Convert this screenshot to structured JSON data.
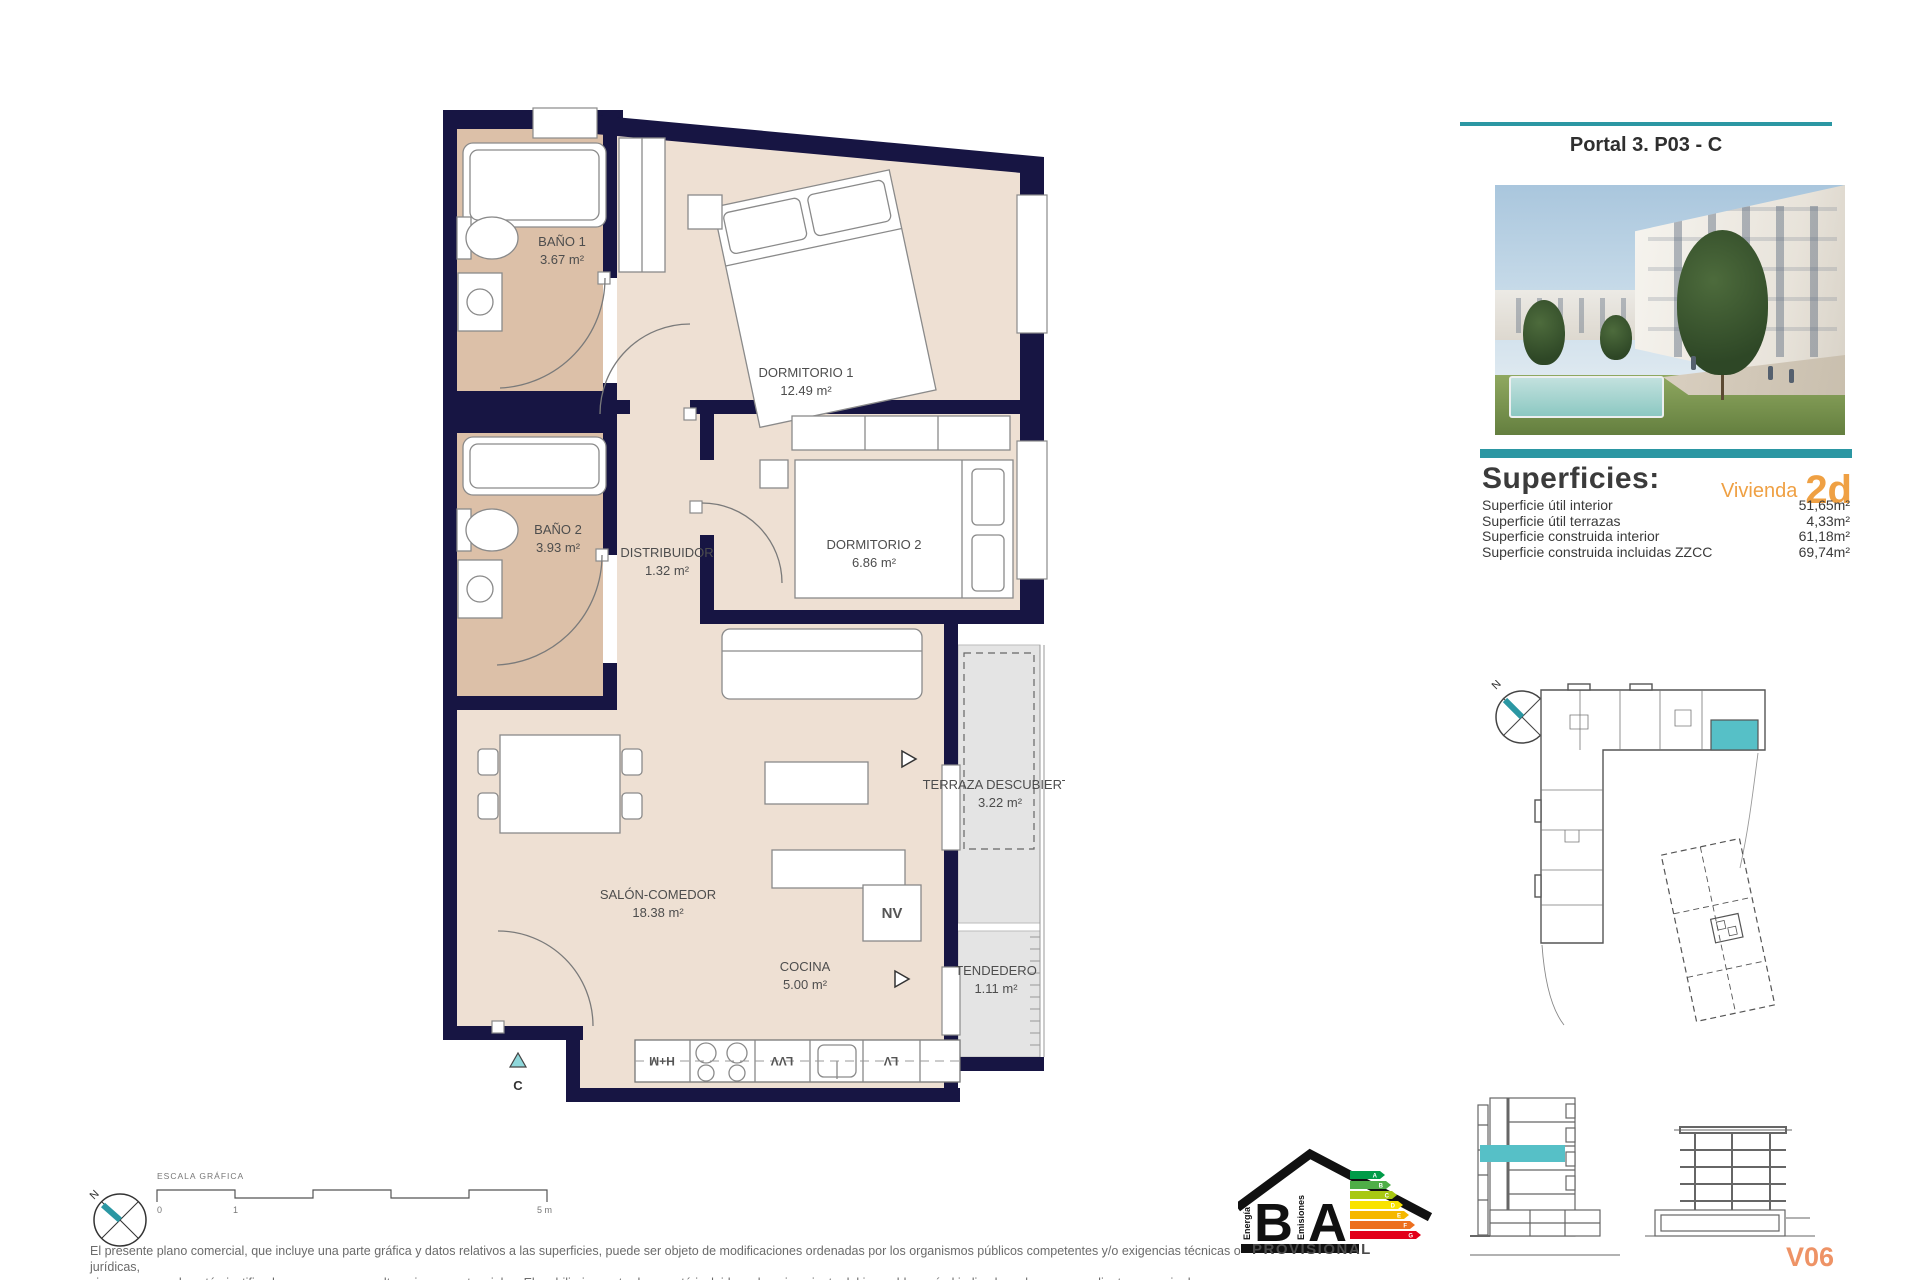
{
  "header": {
    "title": "Portal 3. P03 - C"
  },
  "superficies": {
    "title": "Superficies:",
    "vivienda_label": "Vivienda",
    "vivienda_code": "2d",
    "rows": [
      {
        "label": "Superficie útil interior",
        "value": "51,65m²"
      },
      {
        "label": "Superficie útil terrazas",
        "value": "4,33m²"
      },
      {
        "label": "Superficie construida interior",
        "value": "61,18m²"
      },
      {
        "label": "Superficie construida incluidas ZZCC",
        "value": "69,74m²"
      }
    ]
  },
  "plan": {
    "rooms": [
      {
        "name": "BAÑO 1",
        "area": "3.67 m²"
      },
      {
        "name": "DORMITORIO 1",
        "area": "12.49 m²"
      },
      {
        "name": "BAÑO 2",
        "area": "3.93 m²"
      },
      {
        "name": "DISTRIBUIDOR",
        "area": "1.32 m²"
      },
      {
        "name": "DORMITORIO 2",
        "area": "6.86 m²"
      },
      {
        "name": "SALÓN-COMEDOR",
        "area": "18.38 m²"
      },
      {
        "name": "COCINA",
        "area": "5.00 m²"
      },
      {
        "name": "TERRAZA DESCUBIERTA",
        "area": "3.22 m²"
      },
      {
        "name": "TENDEDERO",
        "area": "1.11 m²"
      }
    ],
    "labels": {
      "nv": "NV",
      "hm": "H+M",
      "lvv": "LVV",
      "lv": "LV",
      "entrance": "C"
    }
  },
  "scale_bar": {
    "title": "ESCALA GRÁFICA",
    "tick_0": "0",
    "tick_1": "1",
    "tick_5": "5 m"
  },
  "compass": {
    "north": "N"
  },
  "site_plan": {
    "north": "N",
    "unit_code": "V06"
  },
  "energy_label": {
    "letter_left": "B",
    "letter_right": "A",
    "left_caption": "Energía",
    "right_caption": "Emisiones",
    "status": "PROVISIONAL",
    "grades": [
      "A",
      "B",
      "C",
      "D",
      "E",
      "F",
      "G"
    ],
    "grade_colors": [
      "#009b48",
      "#4fae47",
      "#a8c813",
      "#f9e300",
      "#f5b800",
      "#ec6f1f",
      "#e2001a"
    ]
  },
  "disclaimer": {
    "line1": "El presente plano comercial, que incluye una parte gráfica y datos relativos a las superficies, puede ser objeto de modificaciones ordenadas por los organismos públicos competentes y/o exigencias técnicas o jurídicas,",
    "line2": "siempre y cuando estén justificados y no supongan alteraciones sustanciales. El mobiliario mostrado no está incluido y el equipamiento del inmueble será el indicado en la correspondiente memoria de calidades"
  },
  "colors": {
    "teal": "#2b97a3",
    "teal_light": "#56c0c7",
    "navy_wall": "#171543",
    "room_light": "#eee0d3",
    "room_bath": "#dcc0a8",
    "terrace_gray": "#e4e4e4",
    "orange_accent": "#efa043",
    "orange_unit": "#ee9366"
  }
}
